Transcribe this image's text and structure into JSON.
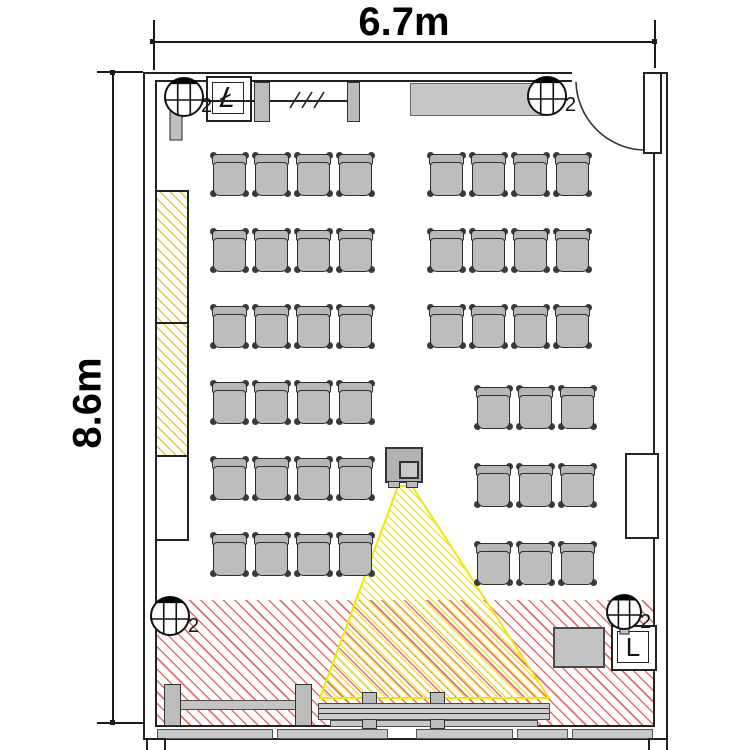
{
  "diagram": {
    "kind": "classroom floor plan",
    "dimensions": {
      "width_label": "6.7m",
      "height_label": "8.6m"
    }
  },
  "panels": {
    "top_left_letter": "Ł",
    "bottom_right_letter": "L"
  },
  "fixtures": [
    {
      "id": "fixture-top-left",
      "cx": 184,
      "cy": 97,
      "r": 19,
      "label": "2",
      "label_x": 201,
      "label_y": 97,
      "bar": {
        "x": 170,
        "y": 84,
        "w": 12,
        "h": 56
      }
    },
    {
      "id": "fixture-top-right",
      "cx": 547,
      "cy": 96,
      "r": 19,
      "label": "2",
      "label_x": 565,
      "label_y": 96
    },
    {
      "id": "fixture-bottom-left",
      "cx": 170,
      "cy": 616,
      "r": 19,
      "label": "2",
      "label_x": 188,
      "label_y": 617
    },
    {
      "id": "fixture-bottom-right",
      "cx": 624,
      "cy": 612,
      "r": 17,
      "label": "2",
      "label_x": 640,
      "label_y": 613,
      "bar": {
        "x": 620,
        "y": 596,
        "w": 9,
        "h": 38
      }
    }
  ],
  "seating": {
    "chair_w": 38,
    "chair_h": 44,
    "blocks": [
      {
        "name": "left-block",
        "x": 211,
        "y": 153,
        "cols": 4,
        "rows": 6,
        "dx": 42,
        "dy": 76
      },
      {
        "name": "right-front-block",
        "x": 428,
        "y": 153,
        "cols": 4,
        "rows": 3,
        "dx": 42,
        "dy": 76
      },
      {
        "name": "right-rear-block",
        "x": 475,
        "y": 386,
        "cols": 3,
        "rows": 3,
        "dx": 42,
        "dy": 78
      }
    ]
  },
  "colors": {
    "red_hatch": "#da4444",
    "yellow_hatch": "#e0c234",
    "beam_yellow": "#f2e60a",
    "chair_fill": "#bdbdbd",
    "wall_line": "#222222"
  }
}
